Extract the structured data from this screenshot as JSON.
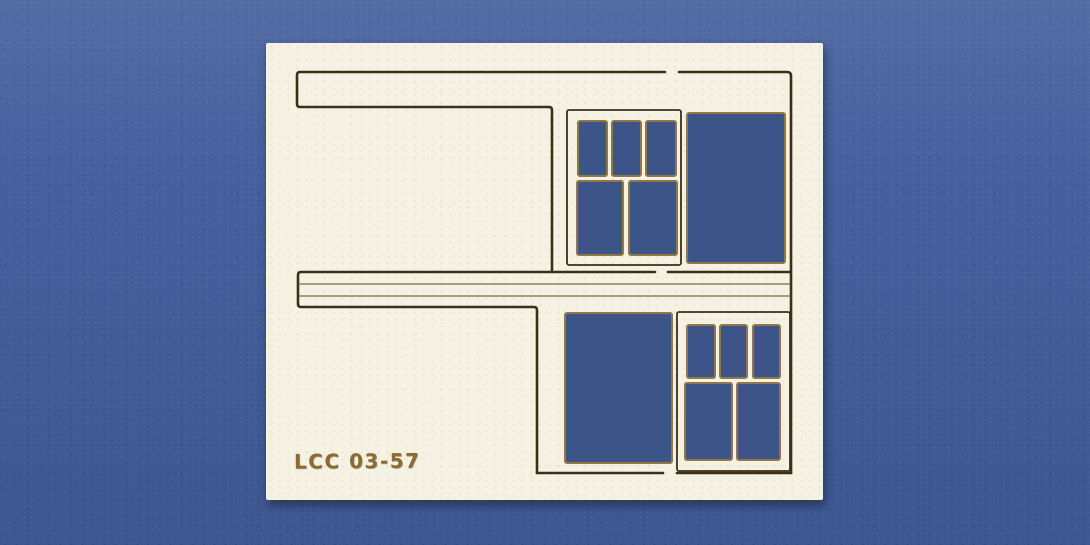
{
  "scene": {
    "description": "Photograph of a cream laser-cut cardboard model building wall sprite on blue textured paper; two sash windows (3 top panes over 2 lower panes), two large rectangular openings, scored fascia bands"
  },
  "part": {
    "code": "LCC 03-57"
  },
  "colors": {
    "background_blue": "#46619f",
    "hole_blue": "#3c5488",
    "card_cream": "#f5f2e4",
    "score_dark": "#3b2f16",
    "score_light": "#7a6840",
    "cut_edge_tan": "#8f7747",
    "engraving_brown": "#8a6c33"
  }
}
